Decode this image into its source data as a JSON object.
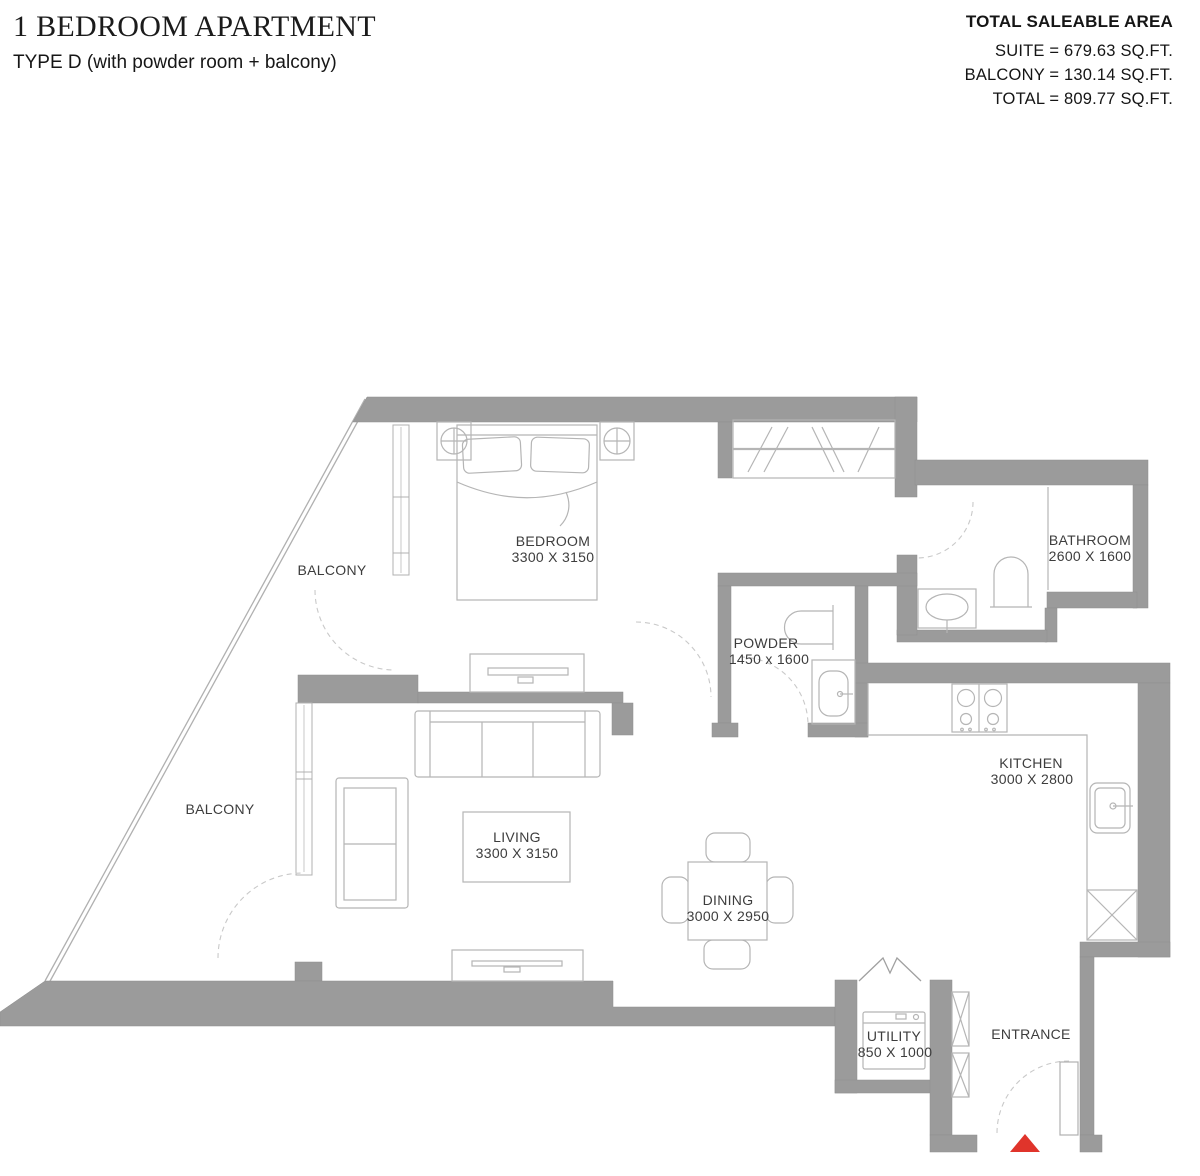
{
  "header": {
    "title": "1 BEDROOM APARTMENT",
    "subtitle": "TYPE D (with powder room + balcony)"
  },
  "area_summary": {
    "heading": "TOTAL SALEABLE AREA",
    "suite": "SUITE = 679.63 SQ.FT.",
    "balcony": "BALCONY = 130.14 SQ.FT.",
    "total": "TOTAL = 809.77 SQ.FT."
  },
  "floor_plan": {
    "rooms": {
      "bedroom": {
        "name": "BEDROOM",
        "dims": "3300 X 3150"
      },
      "bathroom": {
        "name": "BATHROOM",
        "dims": "2600 X 1600"
      },
      "powder": {
        "name": "POWDER",
        "dims": "1450 x 1600"
      },
      "kitchen": {
        "name": "KITCHEN",
        "dims": "3000 X 2800"
      },
      "living": {
        "name": "LIVING",
        "dims": "3300 X 3150"
      },
      "dining": {
        "name": "DINING",
        "dims": "3000 X 2950"
      },
      "utility": {
        "name": "UTILITY",
        "dims": "850 X 1000"
      },
      "entrance": {
        "name": "ENTRANCE"
      },
      "balcony_upper": {
        "name": "BALCONY"
      },
      "balcony_lower": {
        "name": "BALCONY"
      }
    },
    "colors": {
      "wall": "#9b9b9b",
      "line": "#b5b5b5",
      "dash": "#c9c9c9",
      "label": "#3d3d3d",
      "entrance_marker": "#e0342b"
    }
  }
}
